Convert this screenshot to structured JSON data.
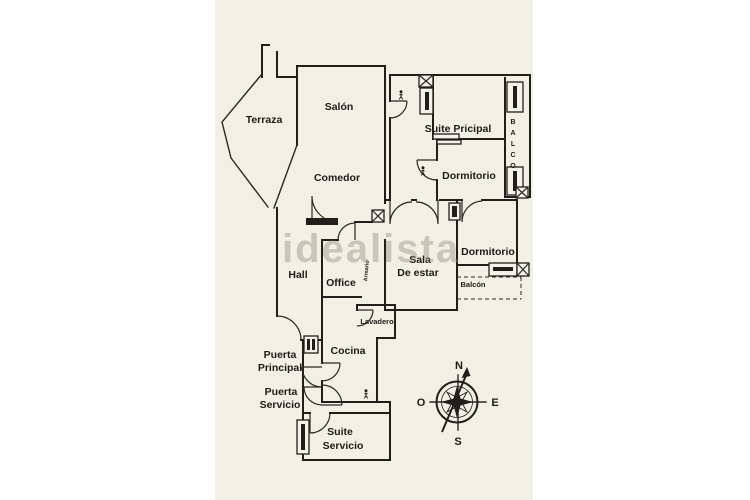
{
  "colors": {
    "page_background": "#ffffff",
    "scan_background": "#f2efe5",
    "line_color": "#211f1c",
    "watermark_color": "#8e8777"
  },
  "watermark": {
    "text": "idealista"
  },
  "rooms": {
    "terraza": "Terraza",
    "salon": "Salón",
    "comedor": "Comedor",
    "hall": "Hall",
    "office": "Office",
    "suite_principal": "Suite Pricipal",
    "dormitorio_1": "Dormitorio",
    "dormitorio_2": "Dormitorio",
    "sala_line1": "Sala",
    "sala_line2": "De estar",
    "balcon": "Balcón",
    "balco_vertical": [
      "B",
      "A",
      "L",
      "C",
      "O"
    ],
    "lavadero": "Lavadero",
    "cocina": "Cocina",
    "armario": "Armario",
    "puerta_principal_line1": "Puerta",
    "puerta_principal_line2": "Principal",
    "puerta_servicio_line1": "Puerta",
    "puerta_servicio_line2": "Servicio",
    "suite_servicio_line1": "Suite",
    "suite_servicio_line2": "Servicio"
  },
  "compass": {
    "north": "N",
    "south": "S",
    "east": "E",
    "west": "O"
  }
}
